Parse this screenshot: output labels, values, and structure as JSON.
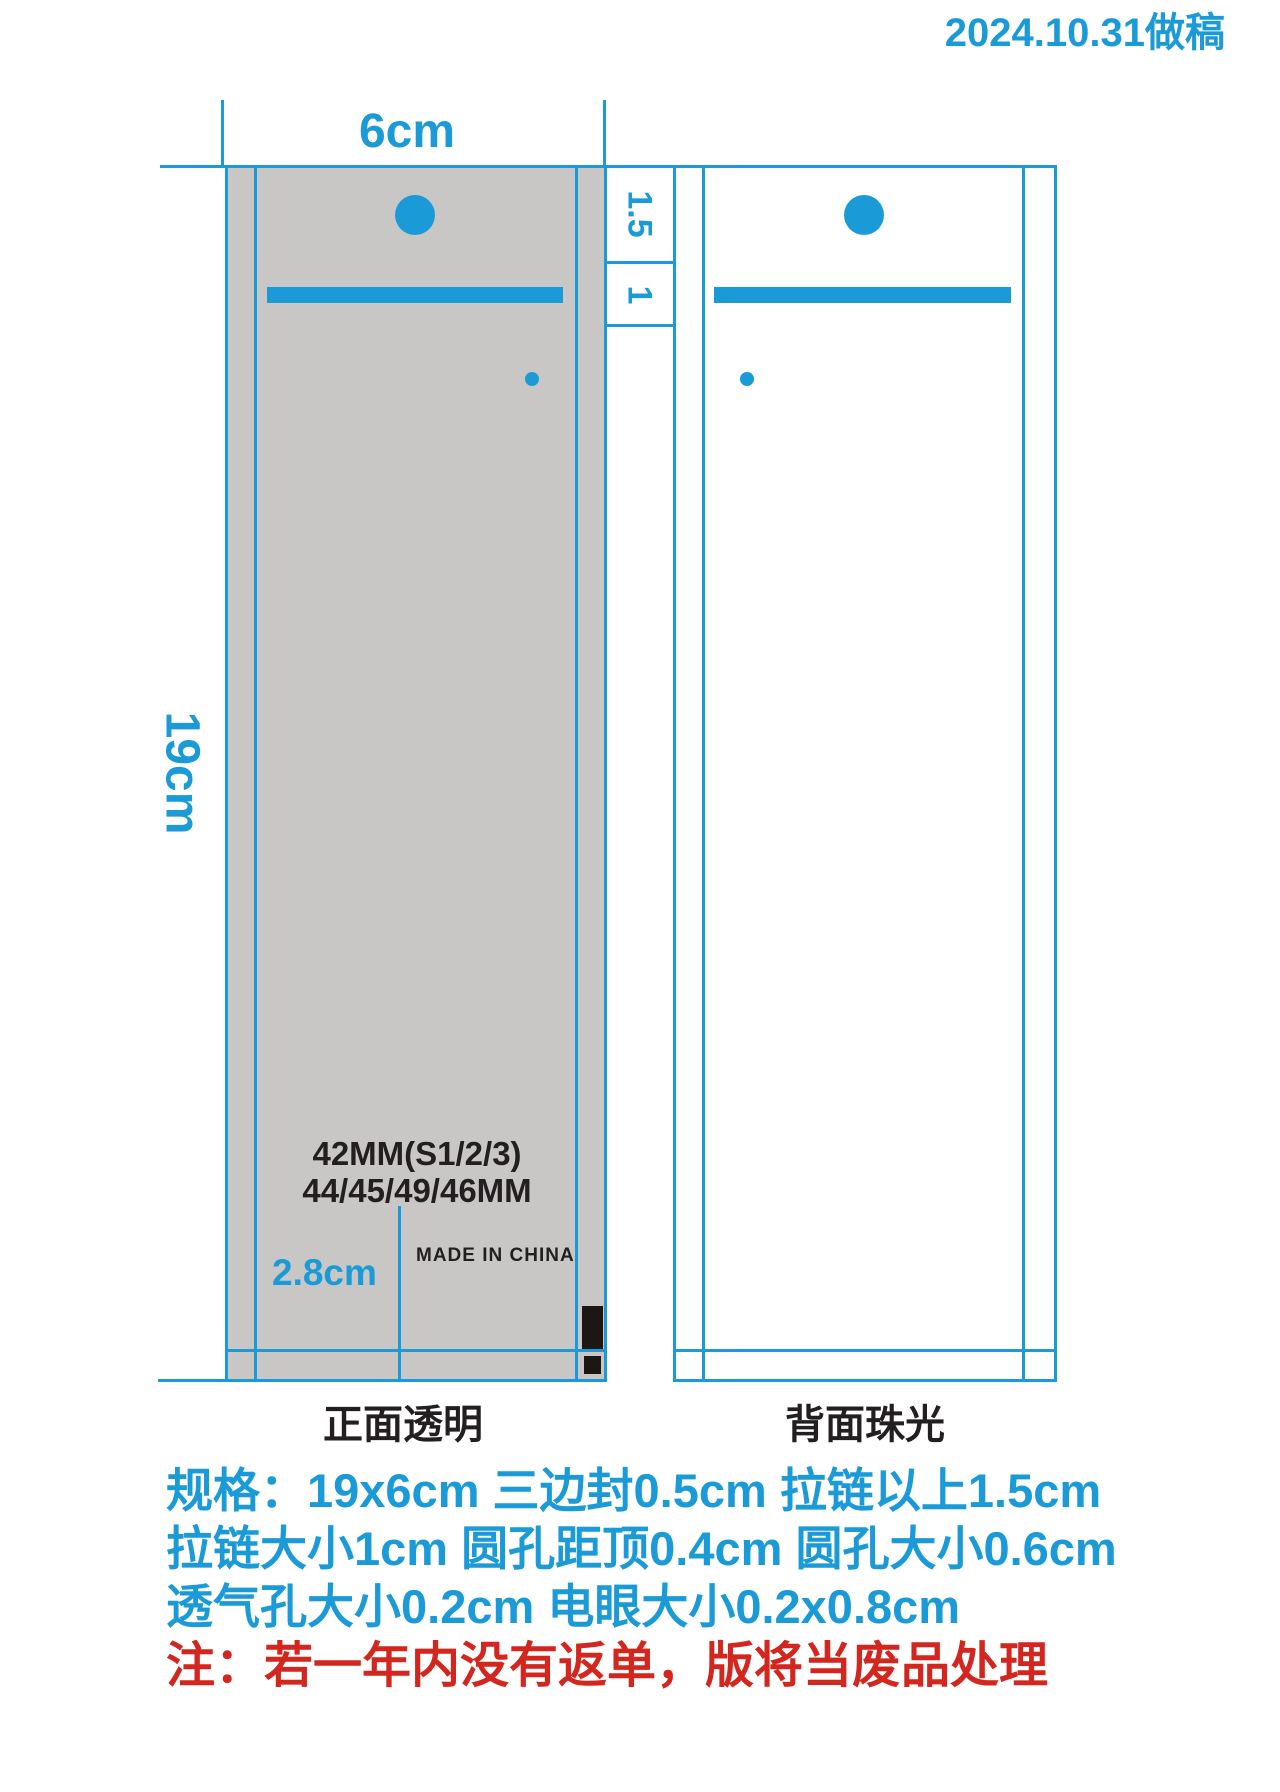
{
  "header": {
    "date_note": "2024.10.31做稿"
  },
  "dimensions": {
    "width": "6cm",
    "height": "19cm",
    "above_zipper": "1.5",
    "zipper": "1",
    "eye_offset": "2.8cm"
  },
  "front_bag": {
    "caption": "正面透明",
    "size_line1": "42MM(S1/2/3)",
    "size_line2": "44/45/49/46MM",
    "origin": "MADE IN CHINA"
  },
  "back_bag": {
    "caption": "背面珠光"
  },
  "specs": {
    "line1": "规格：19x6cm 三边封0.5cm 拉链以上1.5cm",
    "line2": "拉链大小1cm  圆孔距顶0.4cm 圆孔大小0.6cm",
    "line3": "透气孔大小0.2cm  电眼大小0.2x0.8cm",
    "note": "注：若一年内没有返单，版将当废品处理"
  },
  "colors": {
    "blue": "#1a9ad6",
    "bag_gray": "#c8c7c5",
    "red": "#d3261e",
    "text_black": "#231f20"
  }
}
